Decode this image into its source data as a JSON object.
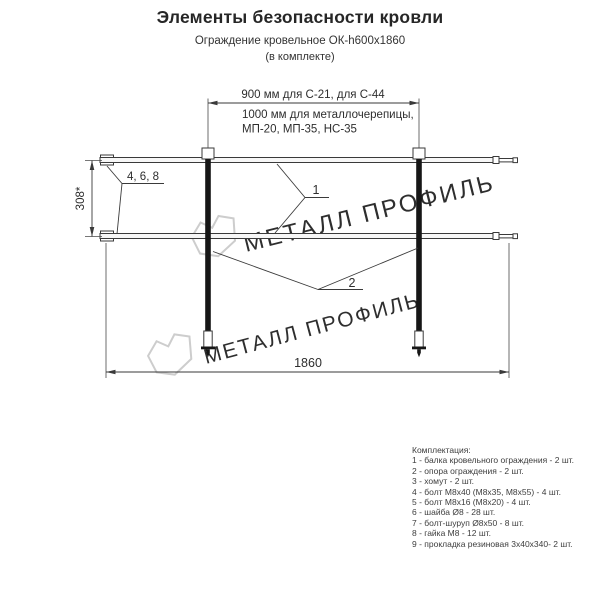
{
  "header": {
    "title": "Элементы безопасности кровли",
    "subtitle": "Ограждение кровельное ОК-h600х1860",
    "note": "(в комплекте)"
  },
  "diagram": {
    "dim_top_900": "900 мм для С-21, для С-44",
    "dim_top_1000_line1": "1000 мм для металлочерепицы,",
    "dim_top_1000_line2": "МП-20, МП-35, НС-35",
    "dim_height": "308*",
    "fastener_label": "4, 6, 8",
    "callout_rail": "1",
    "callout_post": "2",
    "dim_width": "1860",
    "watermark_text": "МЕТАЛЛ ПРОФИЛЬ"
  },
  "parts_list": {
    "heading": "Комплектация:",
    "items": [
      "1 - балка кровельного ограждения - 2 шт.",
      "2 - опора ограждения - 2 шт.",
      "3 - хомут - 2 шт.",
      "4 - болт М8х40 (М8х35, М8х55) - 4 шт.",
      "5 - болт М8х16 (М8х20) - 4 шт.",
      "6 - шайба Ø8 - 28 шт.",
      "7 - болт-шуруп Ø8х50 - 8 шт.",
      "8 - гайка М8 - 12 шт.",
      "9 - прокладка резиновая 3х40х340- 2 шт."
    ]
  },
  "colors": {
    "line": "#3a3a3a",
    "text": "#2e2e2e",
    "watermark": "#cdcdcd",
    "background": "#ffffff"
  }
}
